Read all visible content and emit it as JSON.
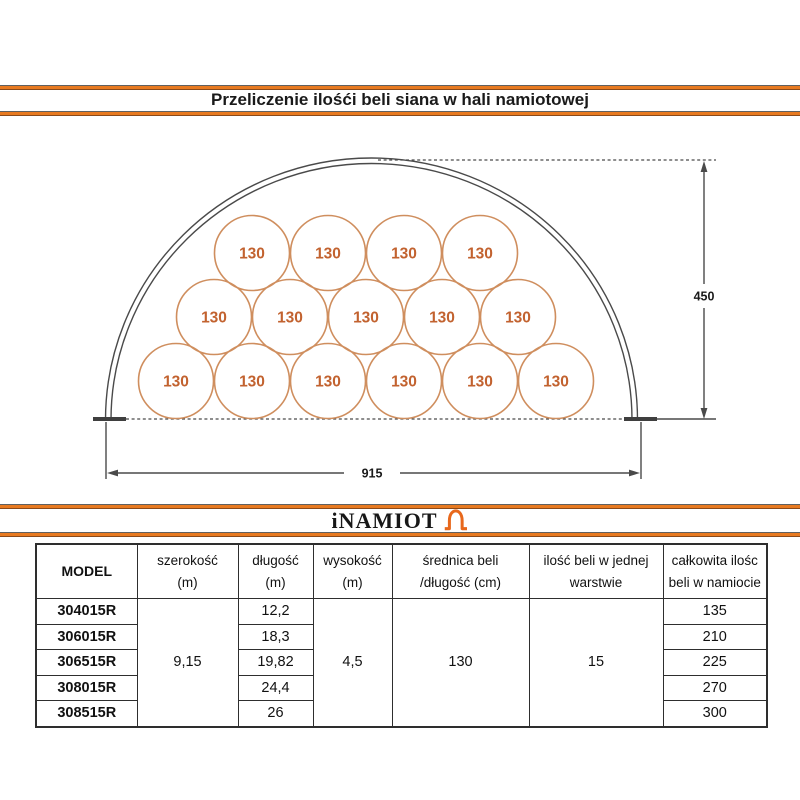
{
  "title": "Przeliczenie ilośći beli siana w hali namiotowej",
  "logo": {
    "text": "iNAMIOT",
    "icon": "tent-icon"
  },
  "colors": {
    "accent_orange": "#e87a20",
    "bale_stroke": "#cf8e5e",
    "bale_text": "#c2622f",
    "line_gray": "#4a4a4a"
  },
  "diagram": {
    "bale_label": "130",
    "height_label": "450",
    "width_label": "915",
    "radius_px": 37.5,
    "rows": [
      {
        "cy": 381,
        "cx": [
          176,
          252,
          328,
          404,
          480,
          556
        ]
      },
      {
        "cy": 317,
        "cx": [
          214,
          290,
          366,
          442,
          518
        ]
      },
      {
        "cy": 253,
        "cx": [
          252,
          328,
          404,
          480
        ]
      }
    ]
  },
  "table": {
    "headers": [
      {
        "l1": "MODEL",
        "l2": ""
      },
      {
        "l1": "szerokość",
        "l2": "(m)"
      },
      {
        "l1": "długość",
        "l2": "(m)"
      },
      {
        "l1": "wysokość",
        "l2": "(m)"
      },
      {
        "l1": "średnica beli",
        "l2": "/długość (cm)"
      },
      {
        "l1": "ilość beli w jednej",
        "l2": "warstwie"
      },
      {
        "l1": "całkowita ilośc",
        "l2": "beli w namiocie"
      }
    ],
    "shared": {
      "szerokosc": "9,15",
      "wysokosc": "4,5",
      "srednica": "130",
      "warstwa": "15"
    },
    "rows": [
      {
        "model": "304015R",
        "dlugosc": "12,2",
        "total": "135"
      },
      {
        "model": "306015R",
        "dlugosc": "18,3",
        "total": "210"
      },
      {
        "model": "306515R",
        "dlugosc": "19,82",
        "total": "225"
      },
      {
        "model": "308015R",
        "dlugosc": "24,4",
        "total": "270"
      },
      {
        "model": "308515R",
        "dlugosc": "26",
        "total": "300"
      }
    ]
  }
}
